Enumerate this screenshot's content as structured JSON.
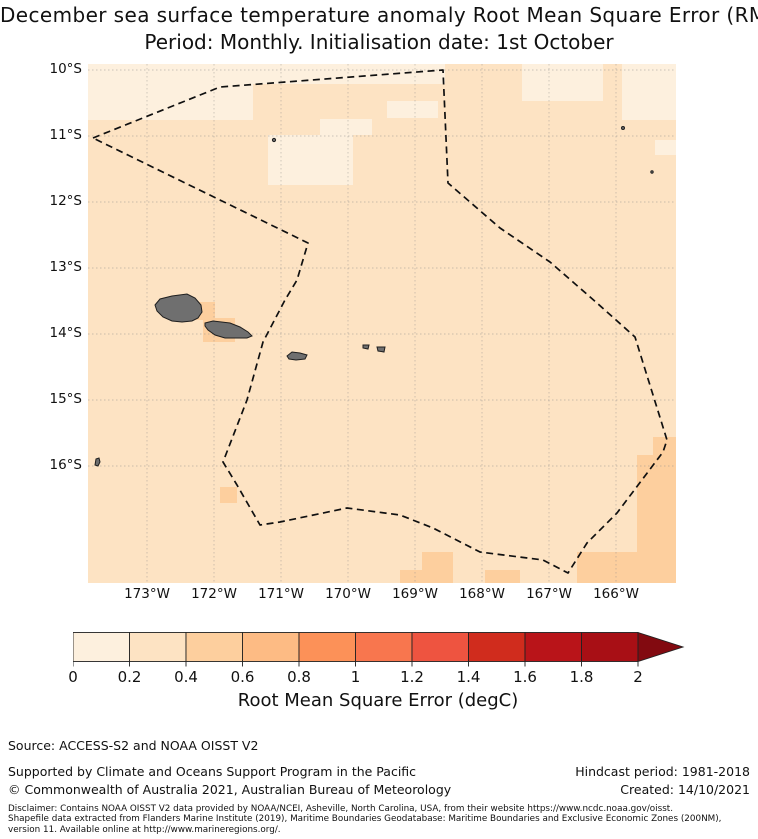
{
  "title": {
    "line1": "December sea surface temperature anomaly Root Mean Square Error (RMSE)",
    "line2": "Period: Monthly. Initialisation date: 1st October"
  },
  "colors": {
    "bins": {
      "0-0.2": "#fdf0de",
      "0.2-0.4": "#fde3c3",
      "0.4-0.6": "#fdcf9e",
      "0.6-0.8": "#fdbb84",
      "0.8-1": "#fc9158",
      "1-1.2": "#f8764e",
      "1.2-1.4": "#ee5440",
      "1.4-1.6": "#d02c1d",
      "1.6-1.8": "#b91419",
      "1.8-2": "#a80f15"
    },
    "arrow": "#820a10",
    "island_fill": "#6f6f6f",
    "island_stroke": "#1f1f1f"
  },
  "map": {
    "base_bin": "0.2-0.4",
    "lat_ticks": [
      {
        "label": "10°S",
        "y": 6
      },
      {
        "label": "11°S",
        "y": 72
      },
      {
        "label": "12°S",
        "y": 138
      },
      {
        "label": "13°S",
        "y": 204
      },
      {
        "label": "14°S",
        "y": 270
      },
      {
        "label": "15°S",
        "y": 336
      },
      {
        "label": "16°S",
        "y": 402
      }
    ],
    "lon_ticks": [
      {
        "label": "173°W",
        "x": 59
      },
      {
        "label": "172°W",
        "x": 126
      },
      {
        "label": "171°W",
        "x": 193
      },
      {
        "label": "170°W",
        "x": 260
      },
      {
        "label": "169°W",
        "x": 327
      },
      {
        "label": "168°W",
        "x": 394
      },
      {
        "label": "167°W",
        "x": 461
      },
      {
        "label": "166°W",
        "x": 528
      }
    ],
    "gridlines": {
      "x": [
        59,
        126,
        193,
        260,
        327,
        394,
        461,
        528
      ],
      "y": [
        6,
        72,
        138,
        204,
        270,
        336,
        402
      ]
    },
    "cells": [
      {
        "x": 0,
        "y": 0,
        "w": 165,
        "h": 56,
        "bin": "0-0.2"
      },
      {
        "x": 165,
        "y": 0,
        "w": 192,
        "h": 20,
        "bin": "0-0.2"
      },
      {
        "x": 434,
        "y": 0,
        "w": 81,
        "h": 37,
        "bin": "0-0.2"
      },
      {
        "x": 534,
        "y": 0,
        "w": 54,
        "h": 56,
        "bin": "0-0.2"
      },
      {
        "x": 299,
        "y": 37,
        "w": 51,
        "h": 17,
        "bin": "0-0.2"
      },
      {
        "x": 232,
        "y": 55,
        "w": 52,
        "h": 16,
        "bin": "0-0.2"
      },
      {
        "x": 180,
        "y": 71,
        "w": 85,
        "h": 50,
        "bin": "0-0.2"
      },
      {
        "x": 567,
        "y": 76,
        "w": 21,
        "h": 15,
        "bin": "0-0.2"
      },
      {
        "x": 105,
        "y": 238,
        "w": 22,
        "h": 18,
        "bin": "0.4-0.6"
      },
      {
        "x": 115,
        "y": 254,
        "w": 32,
        "h": 24,
        "bin": "0.4-0.6"
      },
      {
        "x": 132,
        "y": 423,
        "w": 17,
        "h": 16,
        "bin": "0.4-0.6"
      },
      {
        "x": 565,
        "y": 373,
        "w": 23,
        "h": 33,
        "bin": "0.4-0.6"
      },
      {
        "x": 549,
        "y": 391,
        "w": 39,
        "h": 128,
        "bin": "0.4-0.6"
      },
      {
        "x": 312,
        "y": 506,
        "w": 22,
        "h": 13,
        "bin": "0.4-0.6"
      },
      {
        "x": 334,
        "y": 488,
        "w": 31,
        "h": 31,
        "bin": "0.4-0.6"
      },
      {
        "x": 397,
        "y": 506,
        "w": 35,
        "h": 13,
        "bin": "0.4-0.6"
      },
      {
        "x": 489,
        "y": 488,
        "w": 99,
        "h": 31,
        "bin": "0.4-0.6"
      }
    ],
    "eez": {
      "name": "samoa-eez-boundary",
      "points": [
        [
          5,
          74
        ],
        [
          132,
          23
        ],
        [
          355,
          6
        ],
        [
          360,
          119
        ],
        [
          412,
          164
        ],
        [
          462,
          198
        ],
        [
          509,
          239
        ],
        [
          547,
          273
        ],
        [
          579,
          376
        ],
        [
          575,
          388
        ],
        [
          529,
          449
        ],
        [
          499,
          479
        ],
        [
          480,
          509
        ],
        [
          455,
          496
        ],
        [
          392,
          488
        ],
        [
          345,
          464
        ],
        [
          312,
          451
        ],
        [
          259,
          444
        ],
        [
          192,
          458
        ],
        [
          172,
          461
        ],
        [
          149,
          421
        ],
        [
          135,
          398
        ],
        [
          159,
          336
        ],
        [
          175,
          278
        ],
        [
          197,
          236
        ],
        [
          209,
          216
        ],
        [
          220,
          179
        ]
      ]
    },
    "islands": {
      "polygons": [
        {
          "name": "savaii",
          "points": [
            [
              67,
              241
            ],
            [
              72,
              235
            ],
            [
              84,
              232
            ],
            [
              99,
              230
            ],
            [
              107,
              234
            ],
            [
              113,
              241
            ],
            [
              114,
              248
            ],
            [
              110,
              254
            ],
            [
              104,
              257
            ],
            [
              94,
              258
            ],
            [
              84,
              257
            ],
            [
              75,
              253
            ],
            [
              69,
              247
            ]
          ]
        },
        {
          "name": "upolu",
          "points": [
            [
              117,
              259
            ],
            [
              125,
              257
            ],
            [
              142,
              259
            ],
            [
              152,
              263
            ],
            [
              160,
              268
            ],
            [
              164,
              272
            ],
            [
              159,
              274
            ],
            [
              149,
              274
            ],
            [
              137,
              274
            ],
            [
              127,
              271
            ],
            [
              120,
              266
            ],
            [
              117,
              262
            ]
          ]
        },
        {
          "name": "tutuila",
          "points": [
            [
              199,
              292
            ],
            [
              204,
              288
            ],
            [
              212,
              289
            ],
            [
              219,
              291
            ],
            [
              217,
              295
            ],
            [
              208,
              296
            ],
            [
              201,
              295
            ]
          ]
        },
        {
          "name": "ofu-olosega",
          "points": [
            [
              275,
              281
            ],
            [
              281,
              281
            ],
            [
              280,
              285
            ],
            [
              275,
              284
            ]
          ]
        },
        {
          "name": "tau",
          "points": [
            [
              289,
              283
            ],
            [
              297,
              283
            ],
            [
              296,
              288
            ],
            [
              290,
              287
            ]
          ]
        },
        {
          "name": "niuatoputapu",
          "points": [
            [
              8,
              395
            ],
            [
              11,
              394
            ],
            [
              12,
              398
            ],
            [
              10,
              402
            ],
            [
              7,
              401
            ]
          ]
        }
      ],
      "dots": [
        {
          "name": "swains-island",
          "cx": 186,
          "cy": 76,
          "r": 1.6
        },
        {
          "name": "northeast-islet-a",
          "cx": 535,
          "cy": 64,
          "r": 1.5
        },
        {
          "name": "northeast-islet-b",
          "cx": 564,
          "cy": 108,
          "r": 1.2
        }
      ]
    }
  },
  "colorbar": {
    "bins": [
      "0-0.2",
      "0.2-0.4",
      "0.4-0.6",
      "0.6-0.8",
      "0.8-1",
      "1-1.2",
      "1.2-1.4",
      "1.4-1.6",
      "1.6-1.8",
      "1.8-2"
    ],
    "ticks": [
      "0",
      "0.2",
      "0.4",
      "0.6",
      "0.8",
      "1",
      "1.2",
      "1.4",
      "1.6",
      "1.8",
      "2"
    ],
    "label": "Root Mean Square Error (degC)"
  },
  "footer": {
    "source": "Source: ACCESS-S2 and NOAA OISST V2",
    "supported": "Supported by Climate and Oceans Support Program in the Pacific",
    "copyright": "© Commonwealth of Australia 2021, Australian Bureau of Meteorology",
    "hindcast": "Hindcast period: 1981-2018",
    "created": "Created: 14/10/2021",
    "disclaimer_lines": [
      "Disclaimer: Contains NOAA OISST V2 data provided by NOAA/NCEI, Asheville, North Carolina, USA, from their website https://www.ncdc.noaa.gov/oisst.",
      "Shapefile data extracted from Flanders Marine Institute (2019), Maritime Boundaries Geodatabase: Maritime Boundaries and Exclusive Economic Zones (200NM),",
      "version 11. Available online at http://www.marineregions.org/."
    ]
  },
  "chart_data": {
    "type": "heatmap",
    "title": "December sea surface temperature anomaly Root Mean Square Error (RMSE)",
    "subtitle": "Period: Monthly. Initialisation date: 1st October",
    "x_ticks": [
      "173°W",
      "172°W",
      "171°W",
      "170°W",
      "169°W",
      "168°W",
      "167°W",
      "166°W"
    ],
    "y_ticks": [
      "10°S",
      "11°S",
      "12°S",
      "13°S",
      "14°S",
      "15°S",
      "16°S"
    ],
    "lon_range_deg_west": [
      173.9,
      165.1
    ],
    "lat_range_deg_south": [
      9.9,
      17.8
    ],
    "colorbar": {
      "label": "Root Mean Square Error (degC)",
      "min": 0,
      "max": 2,
      "step": 0.2,
      "extend": "max"
    },
    "value_summary": "RMSE mostly 0.2-0.4 degC across the Samoa EEZ region; patches of 0-0.2 in the north and northeast; 0.4-0.6 around the Samoan islands, one cell near 172.2W/16.4S, and along the southeastern map edges.",
    "overlays": [
      "Samoa EEZ dashed boundary",
      "Savai'i",
      "Upolu",
      "Tutuila",
      "Manu'a islands",
      "Swains Island",
      "Niuatoputapu"
    ]
  }
}
